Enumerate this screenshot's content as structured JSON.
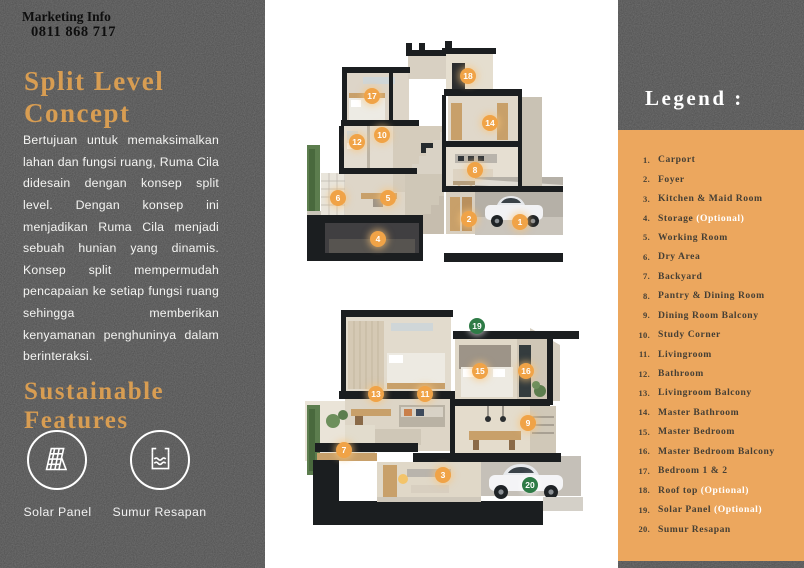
{
  "left_panel": {
    "marketing_label": "Marketing Info",
    "marketing_phone": "0811 868 717",
    "heading": "Split Level Concept",
    "body": "Bertujuan untuk memaksimalkan lahan dan fungsi ruang, Ruma Cila didesain dengan konsep split level. Dengan konsep ini menjadikan Ruma Cila menjadi sebuah hunian yang dinamis. Konsep split mempermudah pencapaian ke setiap fungsi ruang sehingga memberikan kenyamanan penghuninya dalam berinteraksi.",
    "sustainable_heading": "Sustainable Features",
    "features": [
      {
        "icon": "solar-panel-icon",
        "label": "Solar Panel"
      },
      {
        "icon": "infiltration-well-icon",
        "label": "Sumur Resapan"
      }
    ]
  },
  "legend": {
    "title": "Legend :",
    "items": [
      {
        "n": "1.",
        "label": "Carport",
        "suffix": ""
      },
      {
        "n": "2.",
        "label": "Foyer",
        "suffix": ""
      },
      {
        "n": "3.",
        "label": "Kitchen & Maid Room",
        "suffix": ""
      },
      {
        "n": "4.",
        "label": "Storage",
        "suffix": " (Optional)"
      },
      {
        "n": "5.",
        "label": "Working Room",
        "suffix": ""
      },
      {
        "n": "6.",
        "label": "Dry Area",
        "suffix": ""
      },
      {
        "n": "7.",
        "label": "Backyard",
        "suffix": ""
      },
      {
        "n": "8.",
        "label": "Pantry & Dining Room",
        "suffix": ""
      },
      {
        "n": "9.",
        "label": "Dining Room Balcony",
        "suffix": ""
      },
      {
        "n": "10.",
        "label": "Study Corner",
        "suffix": ""
      },
      {
        "n": "11.",
        "label": "Livingroom",
        "suffix": ""
      },
      {
        "n": "12.",
        "label": "Bathroom",
        "suffix": ""
      },
      {
        "n": "13.",
        "label": "Livingroom Balcony",
        "suffix": ""
      },
      {
        "n": "14.",
        "label": "Master Bathroom",
        "suffix": ""
      },
      {
        "n": "15.",
        "label": "Master Bedroom",
        "suffix": ""
      },
      {
        "n": "16.",
        "label": "Master Bedroom Balcony",
        "suffix": ""
      },
      {
        "n": "17.",
        "label": "Bedroom 1 & 2",
        "suffix": ""
      },
      {
        "n": "18.",
        "label": "Roof top",
        "suffix": " (Optional)"
      },
      {
        "n": "19.",
        "label": "Solar Panel",
        "suffix": " (Optional)"
      },
      {
        "n": "20.",
        "label": "Sumur Resapan",
        "suffix": ""
      }
    ]
  },
  "plans": {
    "top": {
      "markers": [
        {
          "n": "17",
          "x": 67,
          "y": 69,
          "color": "orange"
        },
        {
          "n": "18",
          "x": 163,
          "y": 49,
          "color": "orange"
        },
        {
          "n": "14",
          "x": 185,
          "y": 96,
          "color": "orange"
        },
        {
          "n": "12",
          "x": 52,
          "y": 115,
          "color": "orange"
        },
        {
          "n": "10",
          "x": 77,
          "y": 108,
          "color": "orange"
        },
        {
          "n": "8",
          "x": 170,
          "y": 143,
          "color": "orange"
        },
        {
          "n": "6",
          "x": 33,
          "y": 171,
          "color": "orange"
        },
        {
          "n": "5",
          "x": 83,
          "y": 171,
          "color": "orange"
        },
        {
          "n": "2",
          "x": 164,
          "y": 192,
          "color": "orange"
        },
        {
          "n": "1",
          "x": 215,
          "y": 195,
          "color": "orange"
        },
        {
          "n": "4",
          "x": 73,
          "y": 212,
          "color": "orange"
        }
      ]
    },
    "bottom": {
      "markers": [
        {
          "n": "19",
          "x": 174,
          "y": 21,
          "color": "green"
        },
        {
          "n": "15",
          "x": 177,
          "y": 66,
          "color": "orange"
        },
        {
          "n": "16",
          "x": 223,
          "y": 66,
          "color": "orange"
        },
        {
          "n": "13",
          "x": 73,
          "y": 89,
          "color": "orange"
        },
        {
          "n": "11",
          "x": 122,
          "y": 89,
          "color": "orange"
        },
        {
          "n": "9",
          "x": 225,
          "y": 118,
          "color": "orange"
        },
        {
          "n": "7",
          "x": 41,
          "y": 145,
          "color": "orange"
        },
        {
          "n": "3",
          "x": 140,
          "y": 170,
          "color": "orange"
        },
        {
          "n": "20",
          "x": 227,
          "y": 180,
          "color": "green"
        }
      ]
    }
  },
  "colors": {
    "panel_dark": "#4d4d4d",
    "accent_orange": "#d89d52",
    "legend_bg": "#eca75e",
    "marker_orange": "#f0a347",
    "marker_green": "#2e7b46"
  }
}
